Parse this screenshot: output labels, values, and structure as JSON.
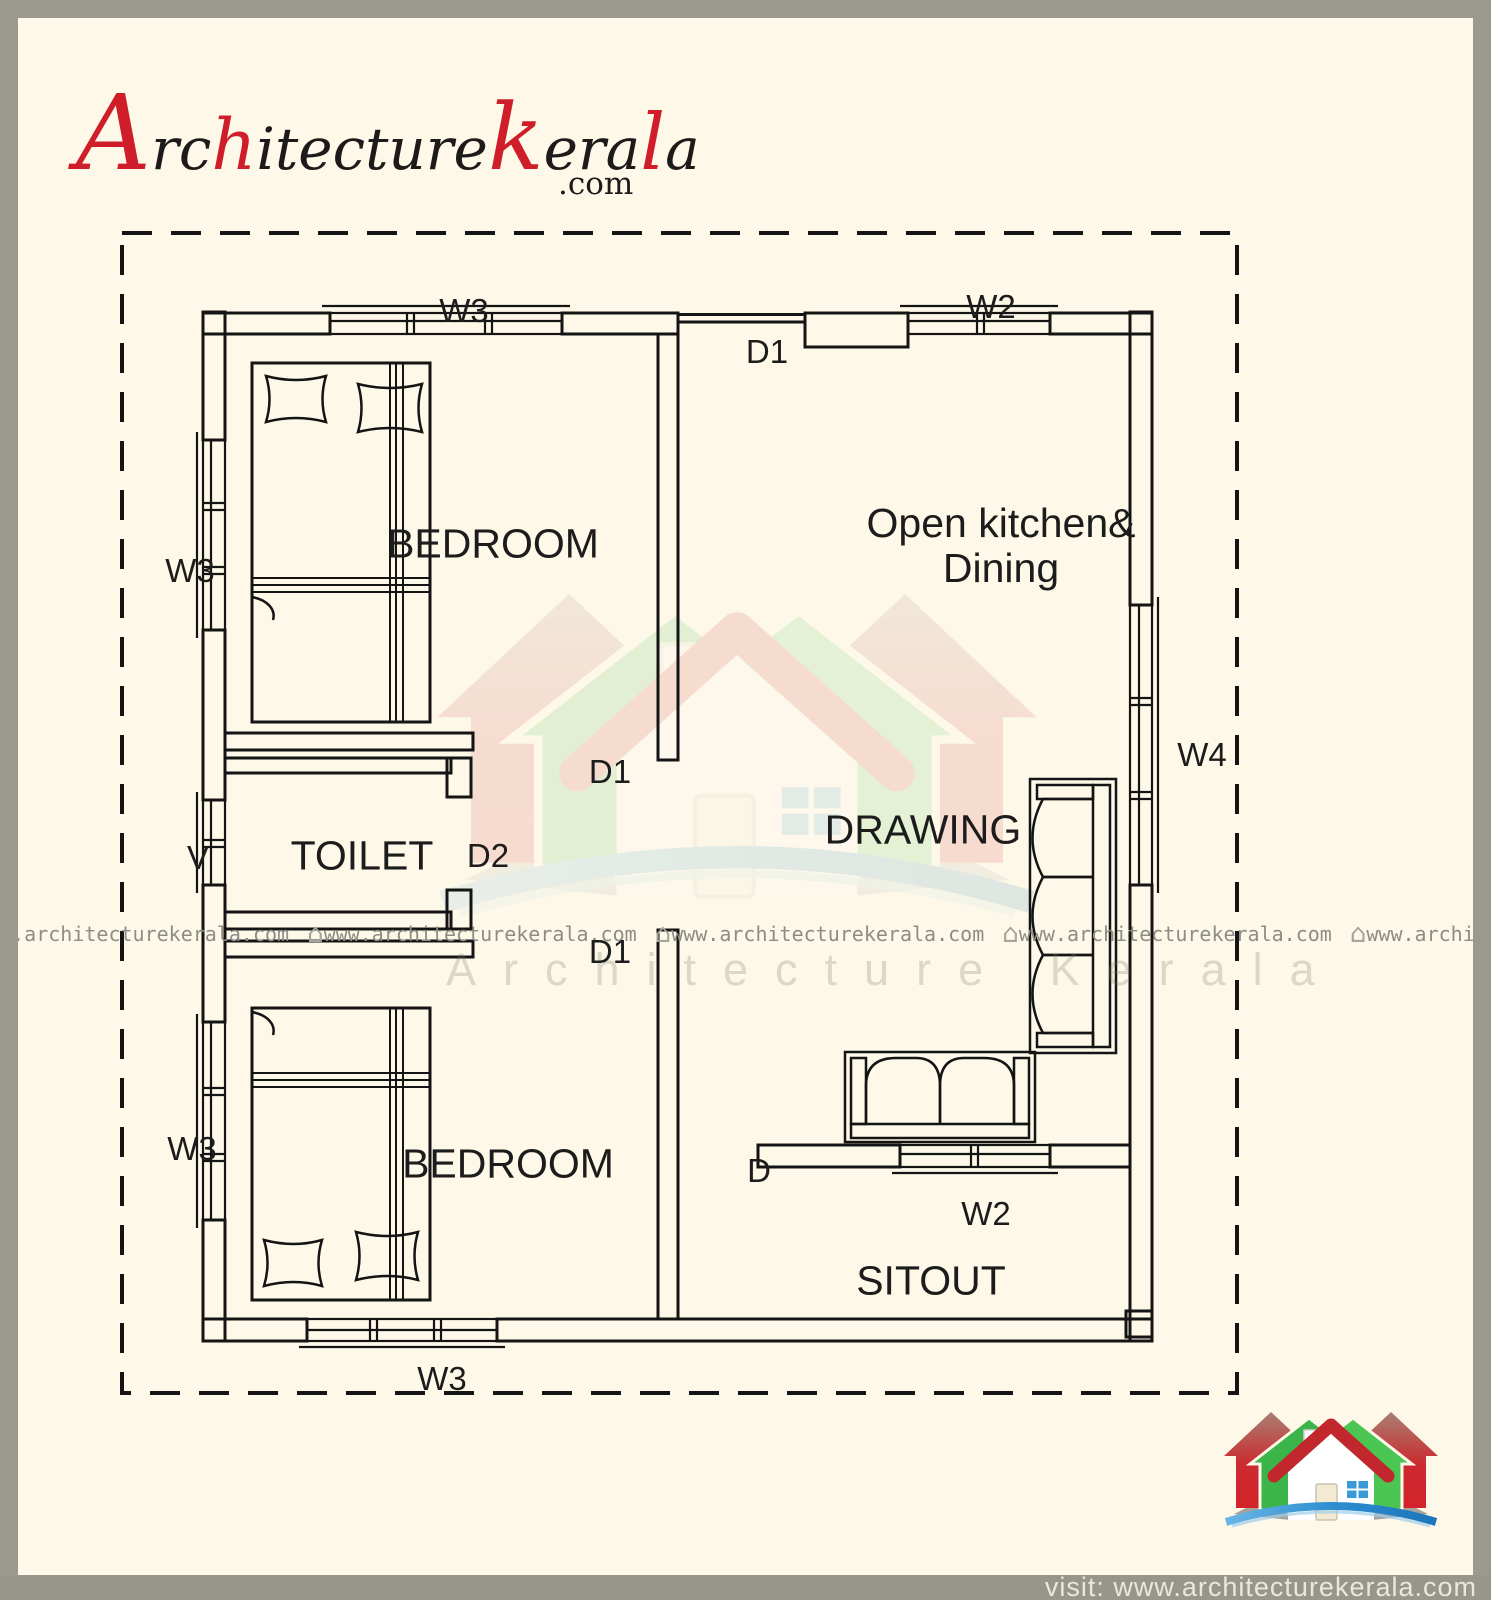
{
  "brand": {
    "name_parts": {
      "p1": "A",
      "p2": "rc",
      "p3": "h",
      "p4": "itecture",
      "p5": "k",
      "p6": "era",
      "p7": "l",
      "p8": "a"
    },
    "tld": ".com"
  },
  "plan": {
    "room_labels": {
      "bedroom1": "BEDROOM",
      "kitchen_line1": "Open kitchen&",
      "kitchen_line2": "Dining",
      "toilet": "TOILET",
      "drawing": "DRAWING",
      "bedroom2": "BEDROOM",
      "sitout": "SITOUT"
    },
    "tags": {
      "w3_top": "W3",
      "w2_top": "W2",
      "d1_top": "D1",
      "w3_left_upper": "W3",
      "v_left": "V",
      "w3_left_lower": "W3",
      "w3_bottom": "W3",
      "w4_right": "W4",
      "d1_mid": "D1",
      "d1_lower": "D1",
      "d2": "D2",
      "d_sitout": "D",
      "w2_sitout": "W2"
    }
  },
  "watermark": {
    "url": "www.architecturekerala.com",
    "house_glyph": "⌂",
    "brand_text": "Architecture Kerala"
  },
  "footer": {
    "text": "visit: www.architecturekerala.com"
  },
  "colors": {
    "logo_red": "#cf1e2a",
    "house_green": "#3bb54a",
    "house_red": "#c1272d",
    "swoosh_blue": "#1b75bb",
    "frame_gray": "#9b988e",
    "paper_cream": "#fdf8e8",
    "line_black": "#141414",
    "watermark_gray": "#8d8d85"
  }
}
